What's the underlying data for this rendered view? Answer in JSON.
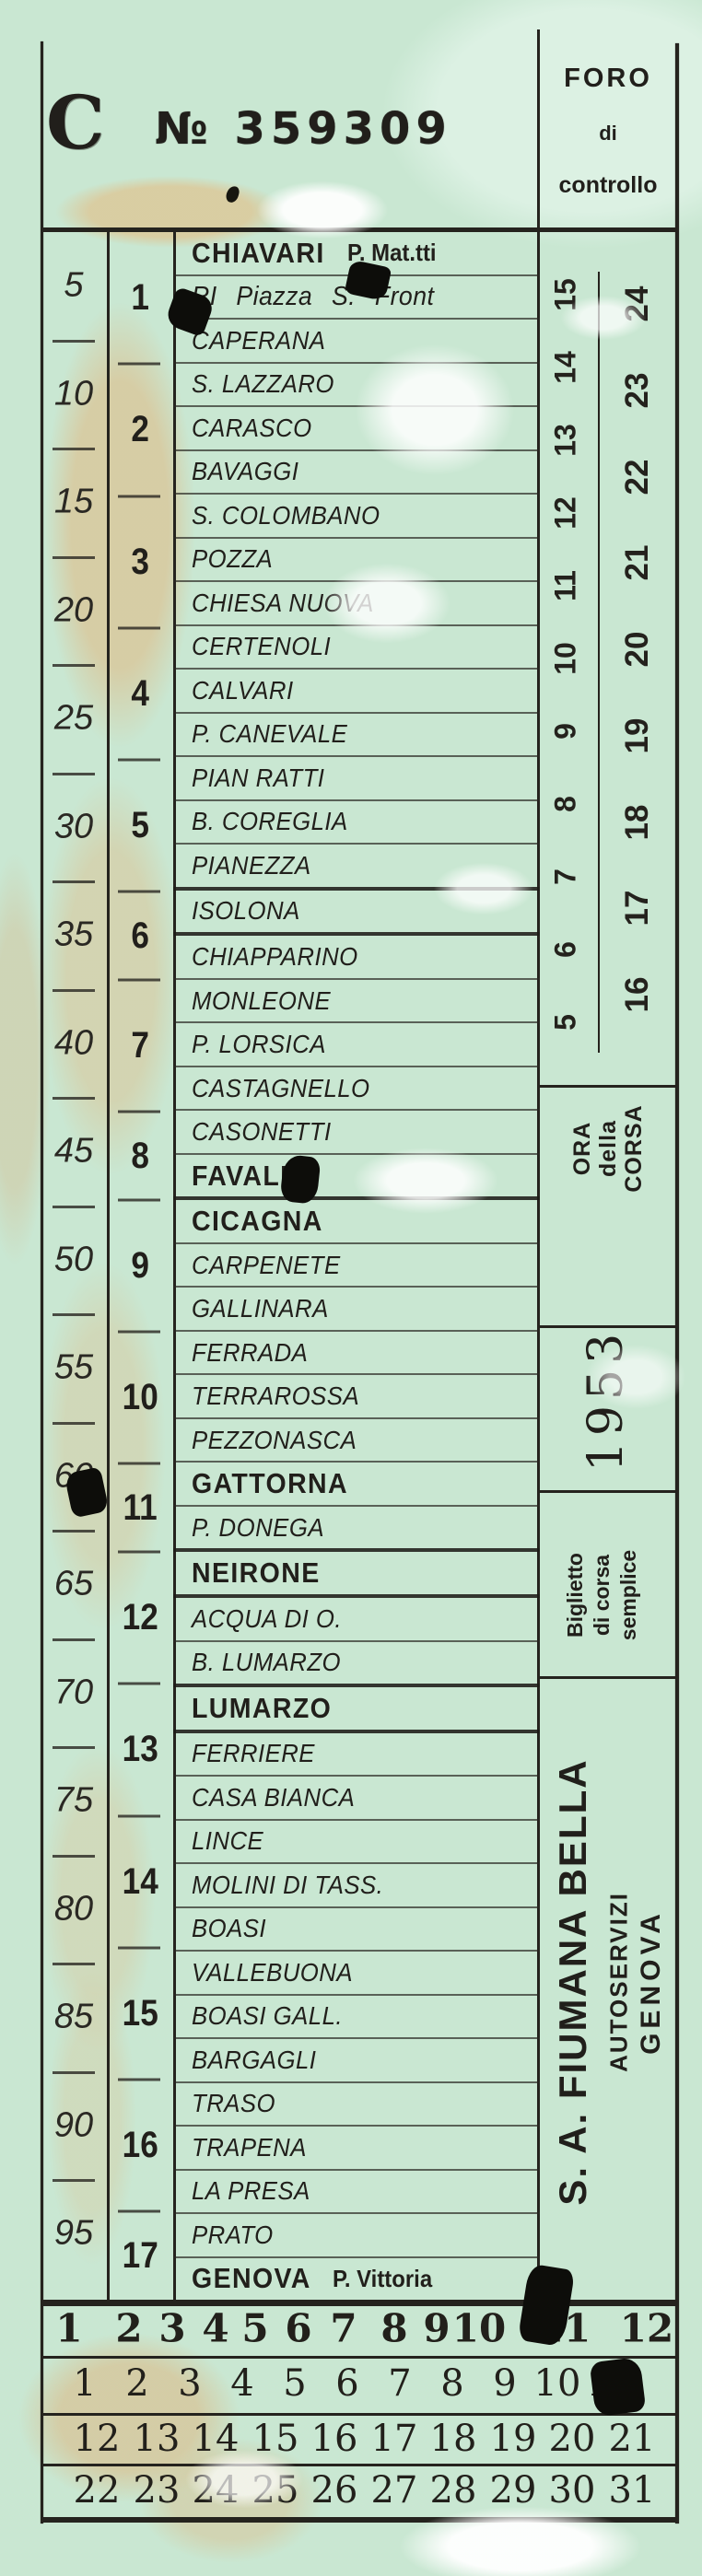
{
  "ticket": {
    "serial": {
      "letter": "C",
      "number": "№ 359309"
    },
    "foro": {
      "line1": "FORO",
      "line2": "di",
      "line3": "controllo"
    },
    "scale_values": [
      "5",
      "10",
      "15",
      "20",
      "25",
      "30",
      "35",
      "40",
      "45",
      "50",
      "55",
      "60",
      "65",
      "70",
      "75",
      "80",
      "85",
      "90",
      "95"
    ],
    "zones": [
      {
        "label": "1",
        "rows": 3
      },
      {
        "label": "2",
        "rows": 3
      },
      {
        "label": "3",
        "rows": 3
      },
      {
        "label": "4",
        "rows": 3
      },
      {
        "label": "5",
        "rows": 3
      },
      {
        "label": "6",
        "rows": 2
      },
      {
        "label": "7",
        "rows": 3
      },
      {
        "label": "8",
        "rows": 2
      },
      {
        "label": "9",
        "rows": 3
      },
      {
        "label": "10",
        "rows": 3
      },
      {
        "label": "11",
        "rows": 2
      },
      {
        "label": "12",
        "rows": 3
      },
      {
        "label": "13",
        "rows": 3
      },
      {
        "label": "14",
        "rows": 3
      },
      {
        "label": "15",
        "rows": 3
      },
      {
        "label": "16",
        "rows": 3
      },
      {
        "label": "17",
        "rows": 2
      }
    ],
    "stations": [
      {
        "name": "CHIAVARI",
        "suffix": "P. Mat.tti",
        "style": "bold"
      },
      {
        "name": "RI Piazza S. Front",
        "style": "mixed"
      },
      {
        "name": "CAPERANA",
        "style": "plain"
      },
      {
        "name": "S. LAZZARO",
        "style": "plain"
      },
      {
        "name": "CARASCO",
        "style": "plain"
      },
      {
        "name": "BAVAGGI",
        "style": "plain"
      },
      {
        "name": "S. COLOMBANO",
        "style": "plain"
      },
      {
        "name": "POZZA",
        "style": "plain"
      },
      {
        "name": "CHIESA NUOVA",
        "style": "plain"
      },
      {
        "name": "CERTENOLI",
        "style": "plain"
      },
      {
        "name": "CALVARI",
        "style": "plain"
      },
      {
        "name": "P. CANEVALE",
        "style": "plain"
      },
      {
        "name": "PIAN RATTI",
        "style": "plain"
      },
      {
        "name": "B. COREGLIA",
        "style": "plain"
      },
      {
        "name": "PIANEZZA",
        "style": "plain",
        "thick": true
      },
      {
        "name": "ISOLONA",
        "style": "plain",
        "thick": true
      },
      {
        "name": "CHIAPPARINO",
        "style": "plain"
      },
      {
        "name": "MONLEONE",
        "style": "plain"
      },
      {
        "name": "P. LORSICA",
        "style": "plain"
      },
      {
        "name": "CASTAGNELLO",
        "style": "plain"
      },
      {
        "name": "CASONETTI",
        "style": "plain"
      },
      {
        "name": "FAVALE",
        "style": "bold",
        "thick": true
      },
      {
        "name": "CICAGNA",
        "style": "bold"
      },
      {
        "name": "CARPENETE",
        "style": "plain"
      },
      {
        "name": "GALLINARA",
        "style": "plain"
      },
      {
        "name": "FERRADA",
        "style": "plain"
      },
      {
        "name": "TERRAROSSA",
        "style": "plain"
      },
      {
        "name": "PEZZONASCA",
        "style": "plain"
      },
      {
        "name": "GATTORNA",
        "style": "bold"
      },
      {
        "name": "P. DONEGA",
        "style": "plain",
        "thick": true
      },
      {
        "name": "NEIRONE",
        "style": "bold",
        "thick": true
      },
      {
        "name": "ACQUA DI O.",
        "style": "plain"
      },
      {
        "name": "B. LUMARZO",
        "style": "plain",
        "thick": true
      },
      {
        "name": "LUMARZO",
        "style": "bold",
        "thick": true
      },
      {
        "name": "FERRIERE",
        "style": "plain"
      },
      {
        "name": "CASA BIANCA",
        "style": "plain"
      },
      {
        "name": "LINCE",
        "style": "plain"
      },
      {
        "name": "MOLINI DI TASS.",
        "style": "plain"
      },
      {
        "name": "BOASI",
        "style": "plain"
      },
      {
        "name": "VALLEBUONA",
        "style": "plain"
      },
      {
        "name": "BOASI GALL.",
        "style": "plain"
      },
      {
        "name": "BARGAGLI",
        "style": "plain"
      },
      {
        "name": "TRASO",
        "style": "plain"
      },
      {
        "name": "TRAPENA",
        "style": "plain"
      },
      {
        "name": "LA PRESA",
        "style": "plain"
      },
      {
        "name": "PRATO",
        "style": "plain"
      },
      {
        "name": "GENOVA",
        "suffix": "P. Vittoria",
        "style": "bold"
      }
    ],
    "hours": {
      "early": [
        "5",
        "6",
        "7",
        "8",
        "9",
        "10",
        "11",
        "12",
        "13",
        "14",
        "15"
      ],
      "late": [
        "16",
        "17",
        "18",
        "19",
        "20",
        "21",
        "22",
        "23",
        "24"
      ]
    },
    "sections": {
      "ora": {
        "line1": "ORA",
        "line2": "della",
        "line3": "CORSA"
      },
      "year": "1953",
      "biglietto": {
        "line1": "Biglietto",
        "line2": "di corsa",
        "line3": "semplice"
      },
      "company": {
        "name": "S. A. FIUMANA BELLA",
        "sub1": "AUTOSERVIZI",
        "sub2": "GENOVA"
      }
    },
    "grid": {
      "row1": [
        "1",
        "2",
        "3",
        "4",
        "5",
        "6",
        "7",
        "8",
        "9",
        "10",
        "11",
        "12"
      ],
      "row2": [
        "1",
        "2",
        "3",
        "4",
        "5",
        "6",
        "7",
        "8",
        "9",
        "10",
        "11"
      ],
      "row3": [
        "12",
        "13",
        "14",
        "15",
        "16",
        "17",
        "18",
        "19",
        "20",
        "21"
      ],
      "row4": [
        "22",
        "23",
        "24",
        "25",
        "26",
        "27",
        "28",
        "29",
        "30",
        "31"
      ]
    },
    "colors": {
      "paper": "#c9e7d2",
      "ink": "#211f1b",
      "beige": "#d8cca4"
    }
  }
}
